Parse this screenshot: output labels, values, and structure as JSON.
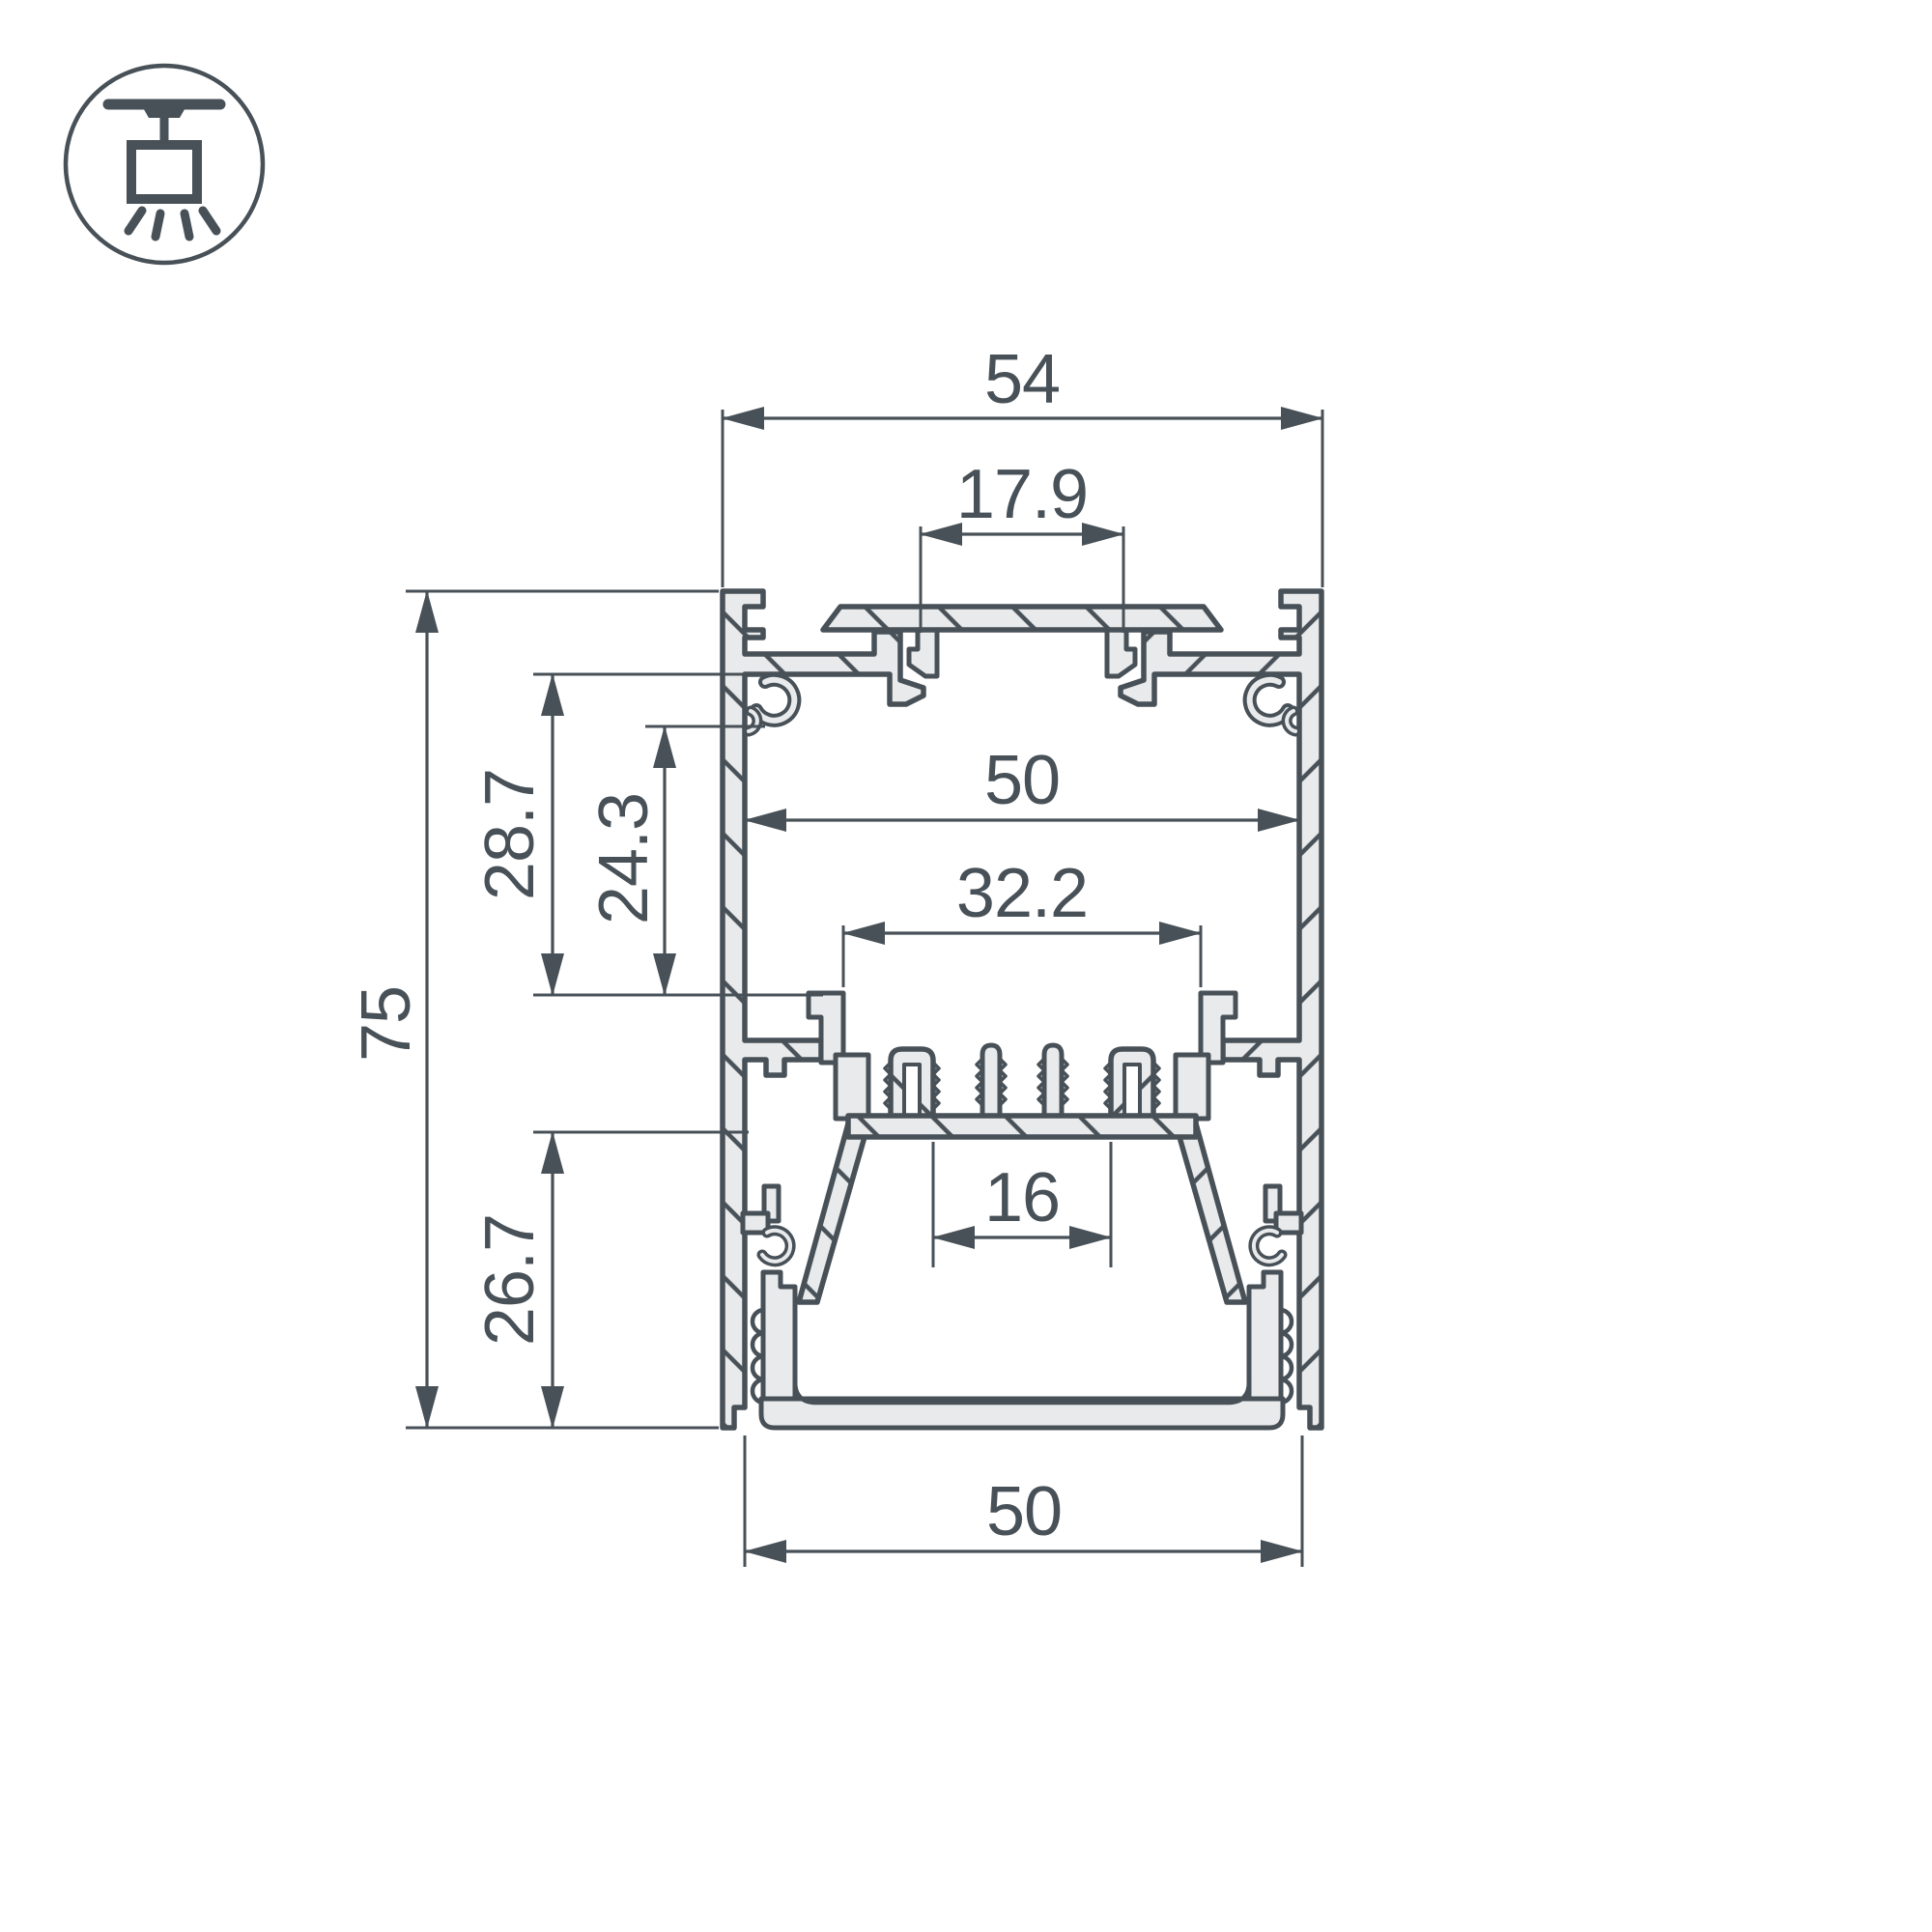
{
  "meta": {
    "title": "Aluminium LED profile cross-section dimension drawing",
    "background_color": "#ffffff",
    "line_color": "#485158",
    "metal_fill_color": "#e9eaeb"
  },
  "icon": {
    "name": "ceiling-surface-mounted-light"
  },
  "dims": {
    "overall_width": "54",
    "top_slot_width": "17.9",
    "inner_width": "50",
    "carrier_width": "32.2",
    "led_shelf_width": "16",
    "bottom_width": "50",
    "overall_height": "75",
    "upper_depth": "28.7",
    "boss_depth": "24.3",
    "lower_depth": "26.7"
  }
}
